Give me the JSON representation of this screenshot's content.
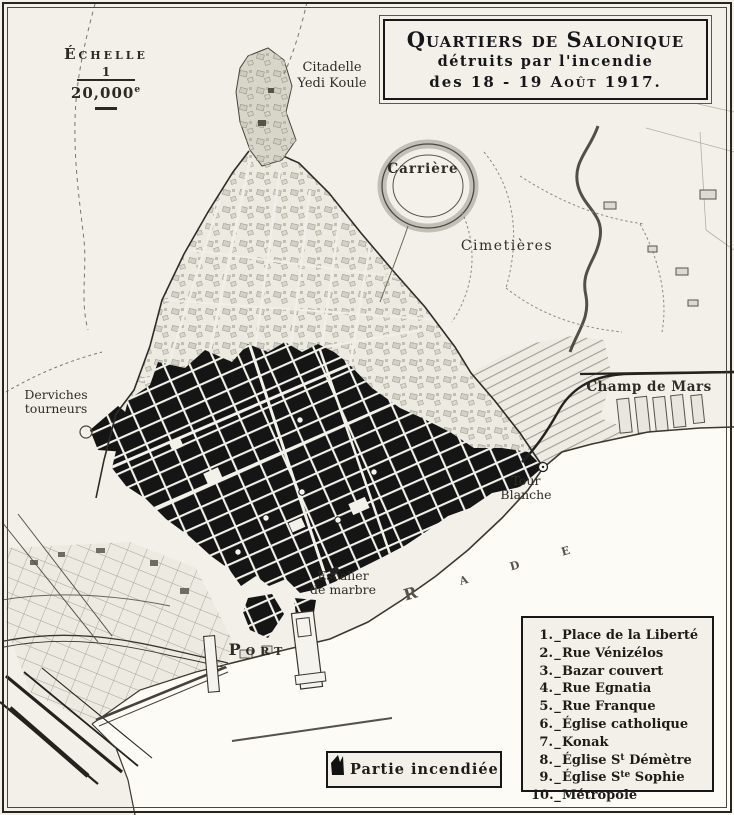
{
  "title_box": {
    "line1": "Quartiers de Salonique",
    "line2": "détruits par l'incendie",
    "line3_prefix": "des  18 - 19",
    "line3_month": "Août",
    "line3_year": "1917."
  },
  "scale": {
    "label": "Échelle",
    "numerator": "1",
    "denominator": "20,000",
    "denominator_sup": "e"
  },
  "map_labels": {
    "citadelle_line1": "Citadelle",
    "citadelle_line2": "Yedi Koule",
    "carriere": "Carrière",
    "cimetieres": "Cimetières",
    "champ_de_mars": "Champ de Mars",
    "derviches_line1": "Derviches",
    "derviches_line2": "tourneurs",
    "tour_blanche_line1": "Tour",
    "tour_blanche_line2": "Blanche",
    "escalier_line1": "Escalier",
    "escalier_line2": "de marbre",
    "port": "Port",
    "rade": "Rade"
  },
  "legend": {
    "sep": "_",
    "items": [
      {
        "num": "1.",
        "pre": "Place de la Liberté",
        "sup": "",
        "post": ""
      },
      {
        "num": "2.",
        "pre": "Rue Vénizélos",
        "sup": "",
        "post": ""
      },
      {
        "num": "3.",
        "pre": "Bazar couvert",
        "sup": "",
        "post": ""
      },
      {
        "num": "4.",
        "pre": "Rue Egnatia",
        "sup": "",
        "post": ""
      },
      {
        "num": "5.",
        "pre": "Rue Franque",
        "sup": "",
        "post": ""
      },
      {
        "num": "6.",
        "pre": "Église catholique",
        "sup": "",
        "post": ""
      },
      {
        "num": "7.",
        "pre": "Konak",
        "sup": "",
        "post": ""
      },
      {
        "num": "8.",
        "pre": "Église S",
        "sup": "t",
        "post": " Démètre"
      },
      {
        "num": "9.",
        "pre": "Église S",
        "sup": "te",
        "post": " Sophie"
      },
      {
        "num": "10.",
        "pre": "Métropole",
        "sup": "",
        "post": ""
      }
    ]
  },
  "burned_legend": {
    "label": "Partie incendiée"
  },
  "colors": {
    "paper": "#f2f0e9",
    "sea": "#fcfbf6",
    "ink": "#2b2921",
    "burnt_fill": "#151515"
  }
}
